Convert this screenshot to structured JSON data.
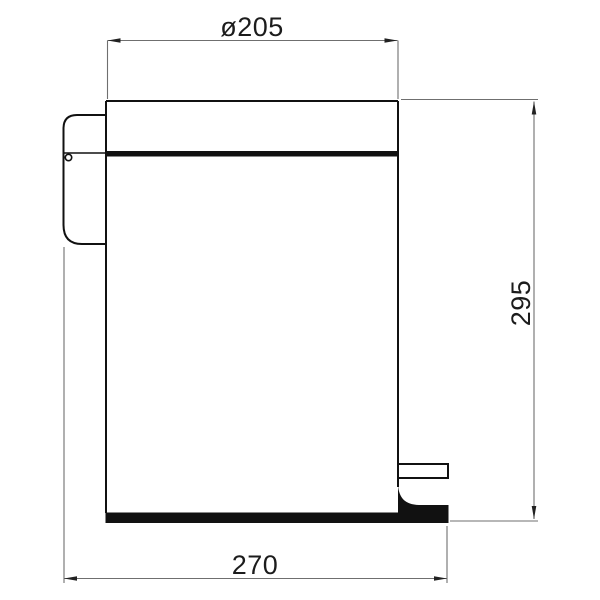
{
  "diagram": {
    "subject": "pedal-bin-side-elevation",
    "dimension_labels": {
      "diameter_top": "ø205",
      "height_right": "295",
      "depth_bottom": "270"
    },
    "colors": {
      "outline": "#111111",
      "dimension": "#6f6f6f",
      "text": "#1c1c1c",
      "background": "#ffffff"
    }
  }
}
